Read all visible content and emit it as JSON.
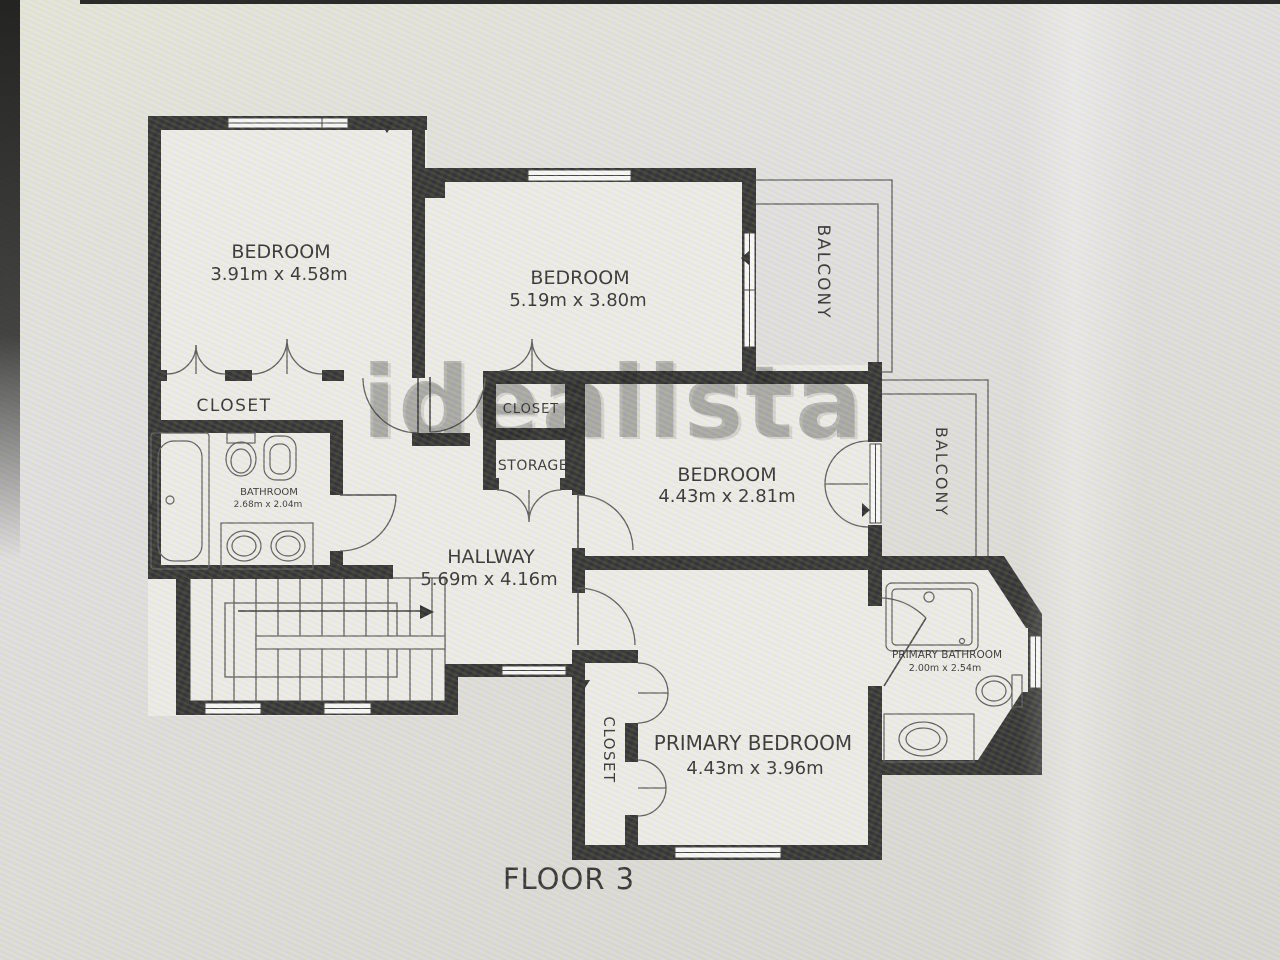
{
  "plan": {
    "floor_label": "FLOOR 3",
    "watermark": "idealista",
    "rooms": {
      "bedroom1": {
        "label": "BEDROOM",
        "dims": "3.91m x 4.58m"
      },
      "bedroom2": {
        "label": "BEDROOM",
        "dims": "5.19m x 3.80m"
      },
      "bedroom3": {
        "label": "BEDROOM",
        "dims": "4.43m x 2.81m"
      },
      "primary_bedroom": {
        "label": "PRIMARY BEDROOM",
        "dims": "4.43m x 3.96m"
      },
      "hallway": {
        "label": "HALLWAY",
        "dims": "5.69m x 4.16m"
      },
      "bathroom": {
        "label": "BATHROOM",
        "dims": "2.68m x 2.04m"
      },
      "primary_bathroom": {
        "label": "PRIMARY BATHROOM",
        "dims": "2.00m x 2.54m"
      },
      "closet_bedroom1": {
        "label": "CLOSET"
      },
      "closet_center": {
        "label": "CLOSET"
      },
      "storage": {
        "label": "STORAGE"
      },
      "closet_primary": {
        "label": "CLOSET"
      },
      "balcony_top": {
        "label": "BALCONY"
      },
      "balcony_right": {
        "label": "BALCONY"
      }
    },
    "colors": {
      "wall": "#1a1a1a",
      "floor": "#f2f1ed",
      "background": "#e2e1dd",
      "watermark": "#767676"
    }
  }
}
